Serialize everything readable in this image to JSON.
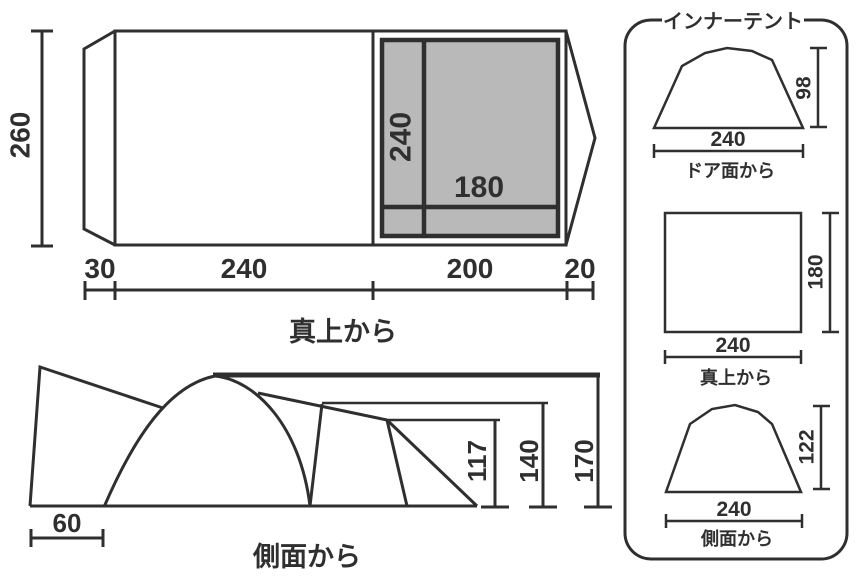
{
  "colors": {
    "line": "#2f2f2f",
    "inner_tent_fill": "#b9b9b9",
    "background": "#ffffff"
  },
  "top_view": {
    "label": "真上から",
    "height_dim": "260",
    "width_dims": [
      "30",
      "240",
      "200",
      "20"
    ],
    "inner_depth": "240",
    "inner_width": "180"
  },
  "side_view": {
    "label": "側面から",
    "front_dim": "60",
    "heights": [
      "117",
      "140",
      "170"
    ]
  },
  "inner_tent": {
    "title": "インナーテント",
    "views": [
      {
        "label": "ドア面から",
        "width": "240",
        "height": "98"
      },
      {
        "label": "真上から",
        "width": "240",
        "height": "180"
      },
      {
        "label": "側面から",
        "width": "240",
        "height": "122"
      }
    ]
  }
}
